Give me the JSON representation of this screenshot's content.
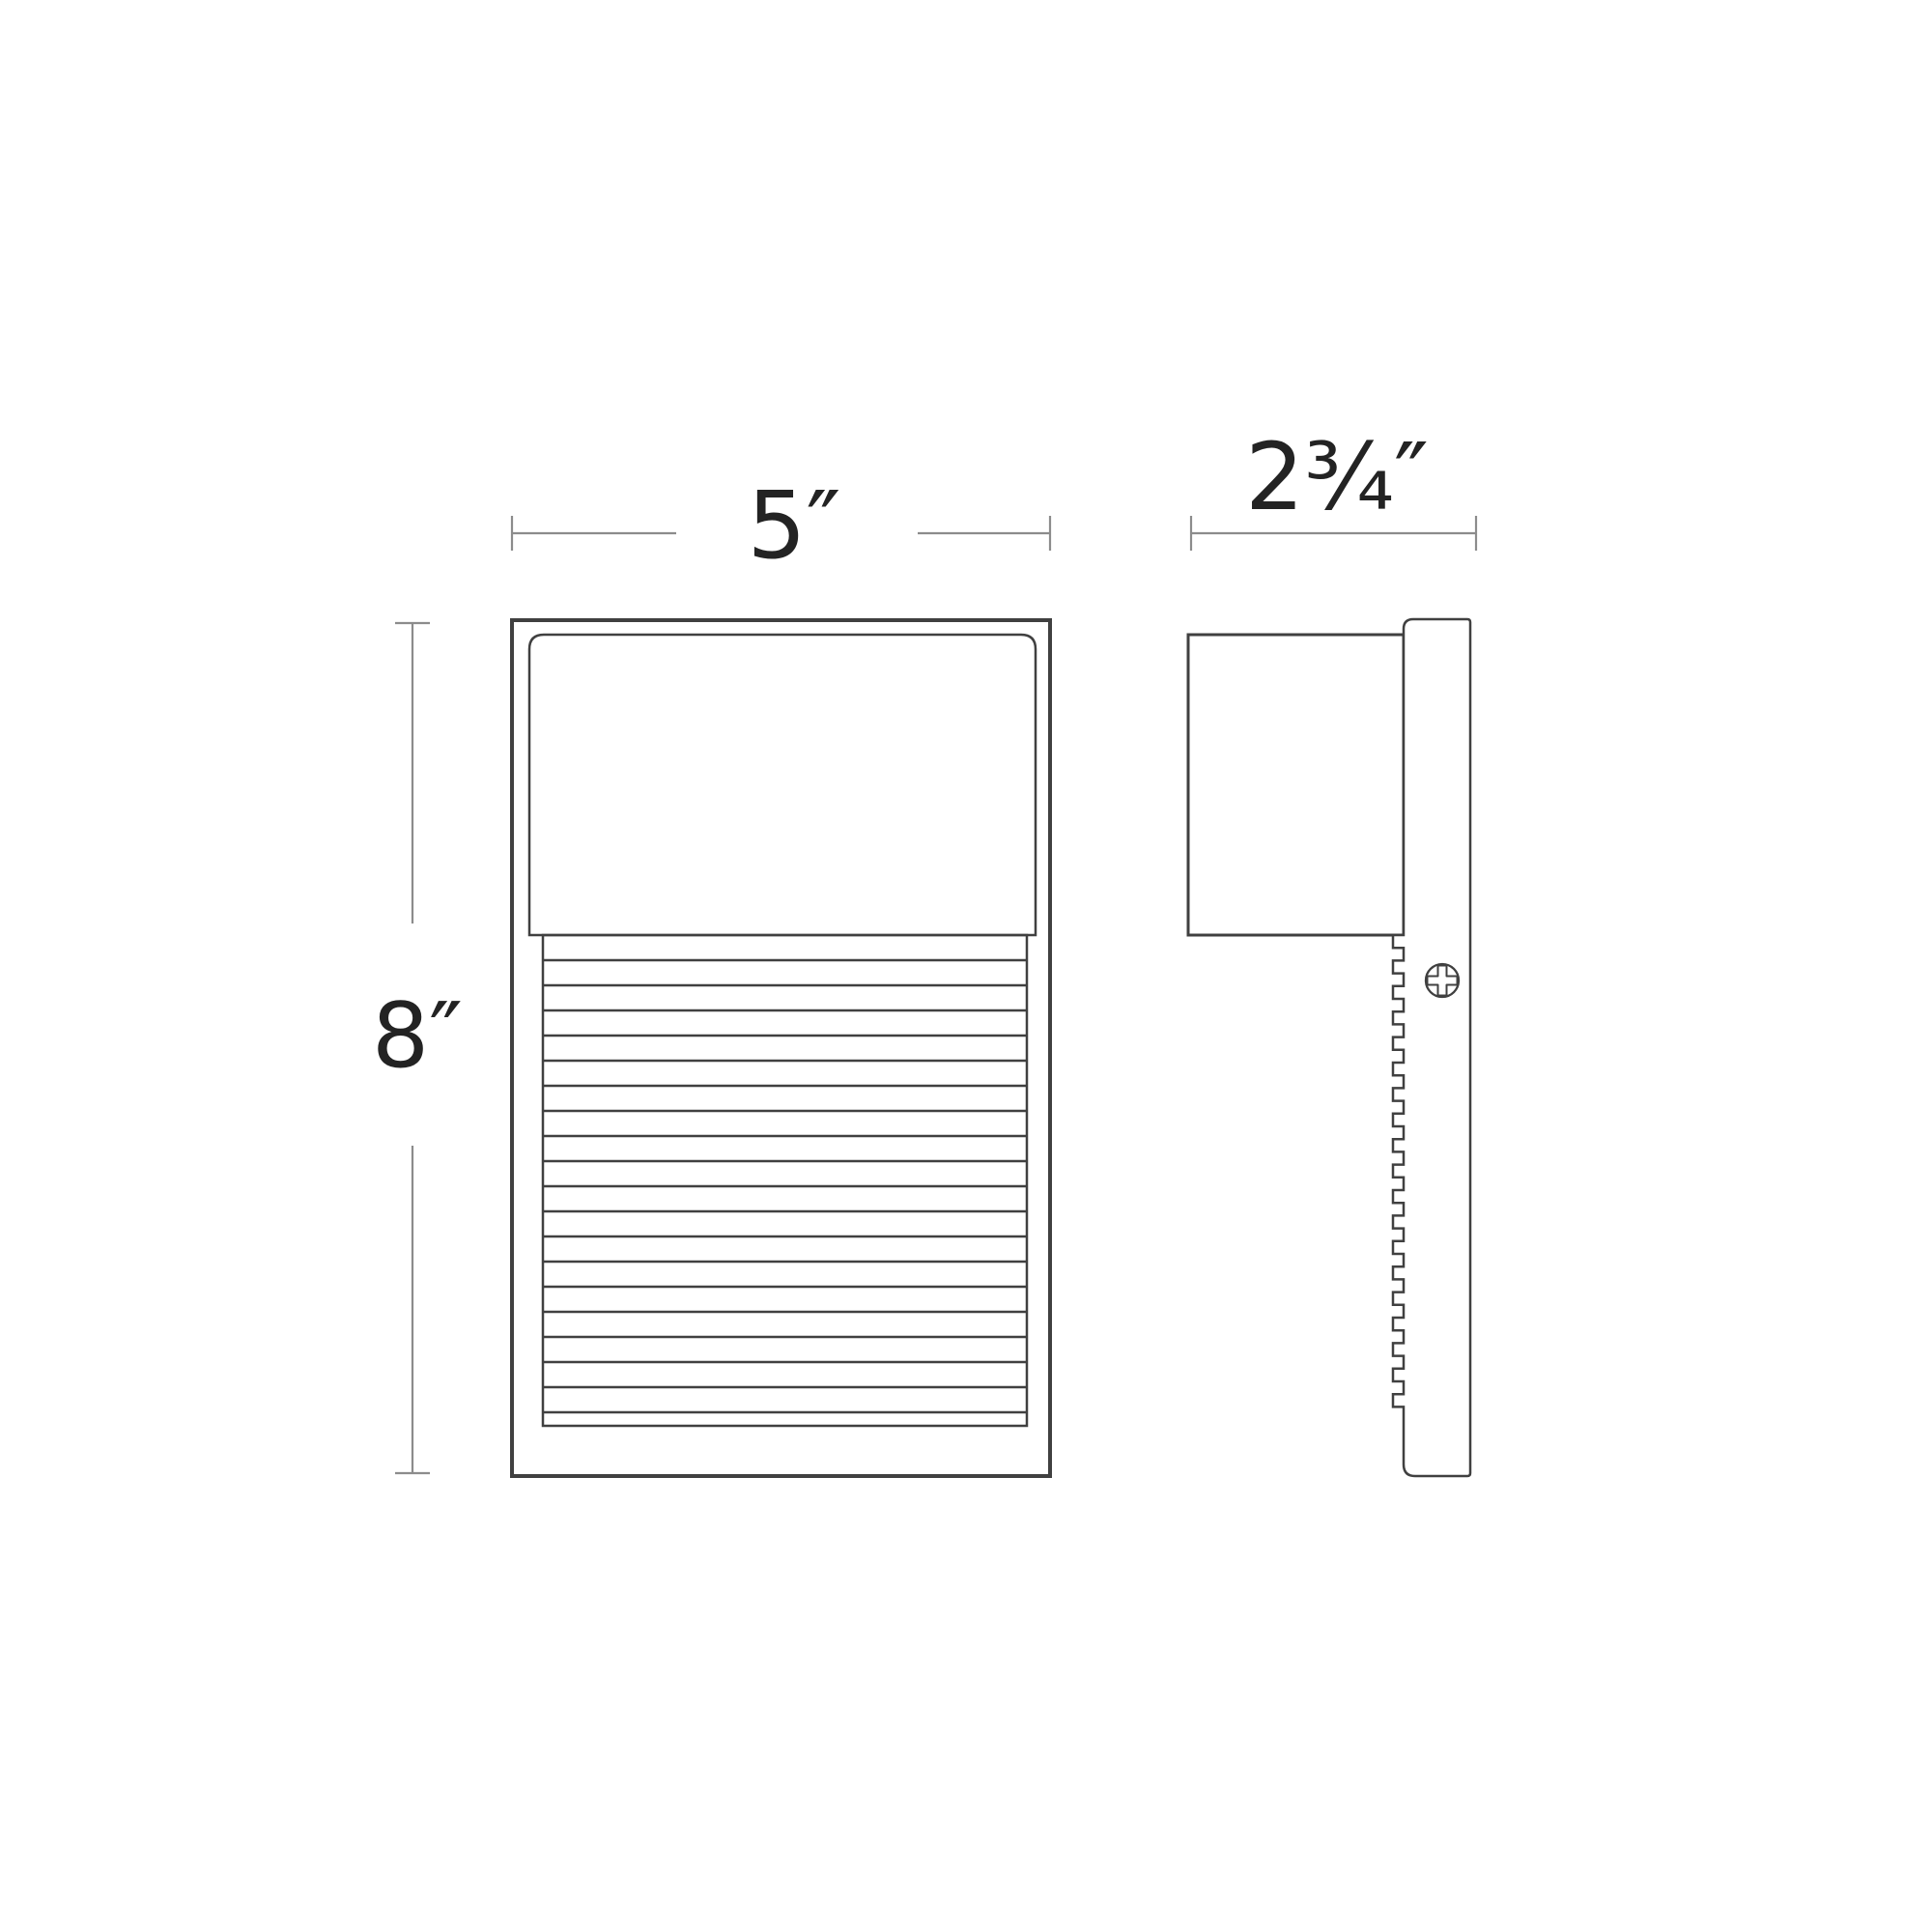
{
  "diagram": {
    "type": "product-dimension-drawing",
    "background": "#ffffff",
    "colors": {
      "outline": "#404040",
      "dimension_line": "#8c8c8c",
      "label_text": "#232323"
    },
    "labels": {
      "width": "5″",
      "depth": "2¾″",
      "height": "8″"
    }
  }
}
